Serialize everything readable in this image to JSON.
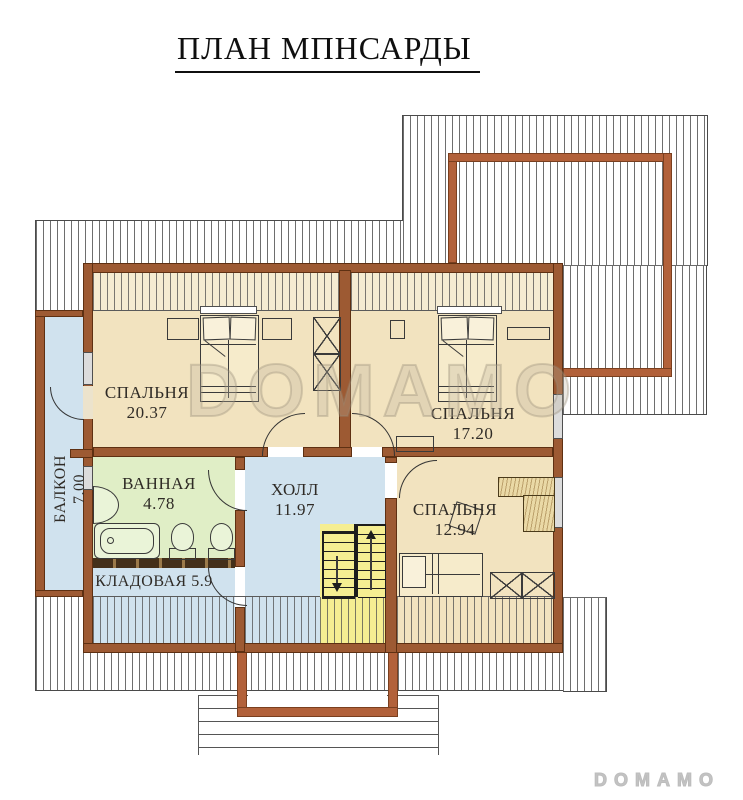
{
  "title": "ПЛАН МПНСАРДЫ",
  "watermark": "DOMAMO",
  "brand_logo": "DOMAMO",
  "rooms": {
    "bedroom_1": {
      "name": "СПАЛЬНЯ",
      "area": "20.37"
    },
    "bedroom_2": {
      "name": "СПАЛЬНЯ",
      "area": "17.20"
    },
    "bedroom_3": {
      "name": "СПАЛЬНЯ",
      "area": "12.94"
    },
    "bathroom": {
      "name": "ВАННАЯ",
      "area": "4.78"
    },
    "hall": {
      "name": "ХОЛЛ",
      "area": "11.97"
    },
    "storage": {
      "name": "КЛАДОВАЯ",
      "area": "5.9"
    },
    "balcony": {
      "name": "БАЛКОН",
      "area": "7.00"
    }
  },
  "colors": {
    "wall_brown": "#9d5a33",
    "outline_frame_brown": "#b2613a",
    "room_beige": "#f2e3bf",
    "room_blue": "#d0e2ee",
    "bathroom_green": "#e0eec6",
    "stair_yellow": "#f5ee92",
    "hatch_line_gray": "#6e6e6e"
  }
}
